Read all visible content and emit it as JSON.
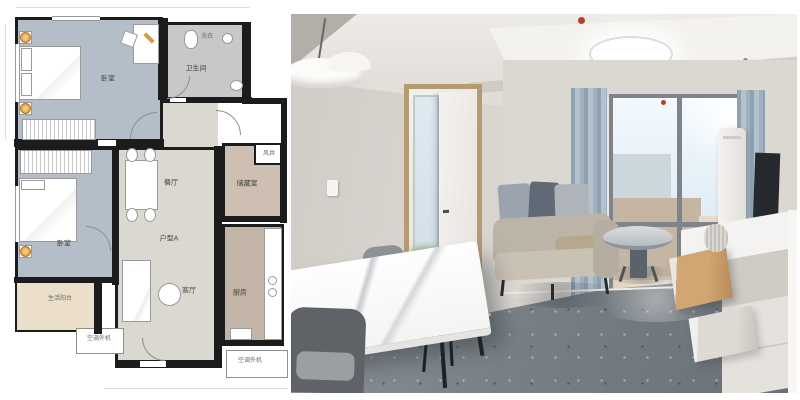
{
  "floorplan": {
    "rooms": {
      "bedroom1": {
        "label": "卧室"
      },
      "bedroom2": {
        "label": "卧室"
      },
      "bathroom": {
        "label": "卫生间"
      },
      "laundry": {
        "label": "洗衣"
      },
      "dining": {
        "label": "餐厅"
      },
      "unit_tag": {
        "label": "户型A"
      },
      "living": {
        "label": "客厅"
      },
      "kitchen": {
        "label": "厨房"
      },
      "storage": {
        "label": "储藏室"
      },
      "shaft": {
        "label": "风井"
      },
      "balcony": {
        "label": "生活阳台"
      },
      "ac_unit_left": {
        "label": "空调外机"
      },
      "ac_unit_right": {
        "label": "空调外机"
      }
    },
    "colors": {
      "wall": "#1c1c1c",
      "bedroom_fill": "#b4bec9",
      "bathroom_fill": "#c6c8ca",
      "hall_fill": "#dbd8d2",
      "storage_fill": "#cdbfb1",
      "kitchen_fill": "#c2b4a6",
      "balcony_fill": "#ebdfca",
      "lamp_accent": "#dd9a3c"
    }
  },
  "photo": {
    "colors": {
      "wall": "#d5d1cb",
      "ceiling": "#edebe8",
      "floor": "#788086",
      "sofa": "#bdb4a8",
      "curtain": "#9fb0bf",
      "sky": "#e2eef7",
      "door_wood": "#b59a73",
      "drawer_wood": "#d0a672",
      "alarm_red": "#bf3a2b"
    }
  }
}
